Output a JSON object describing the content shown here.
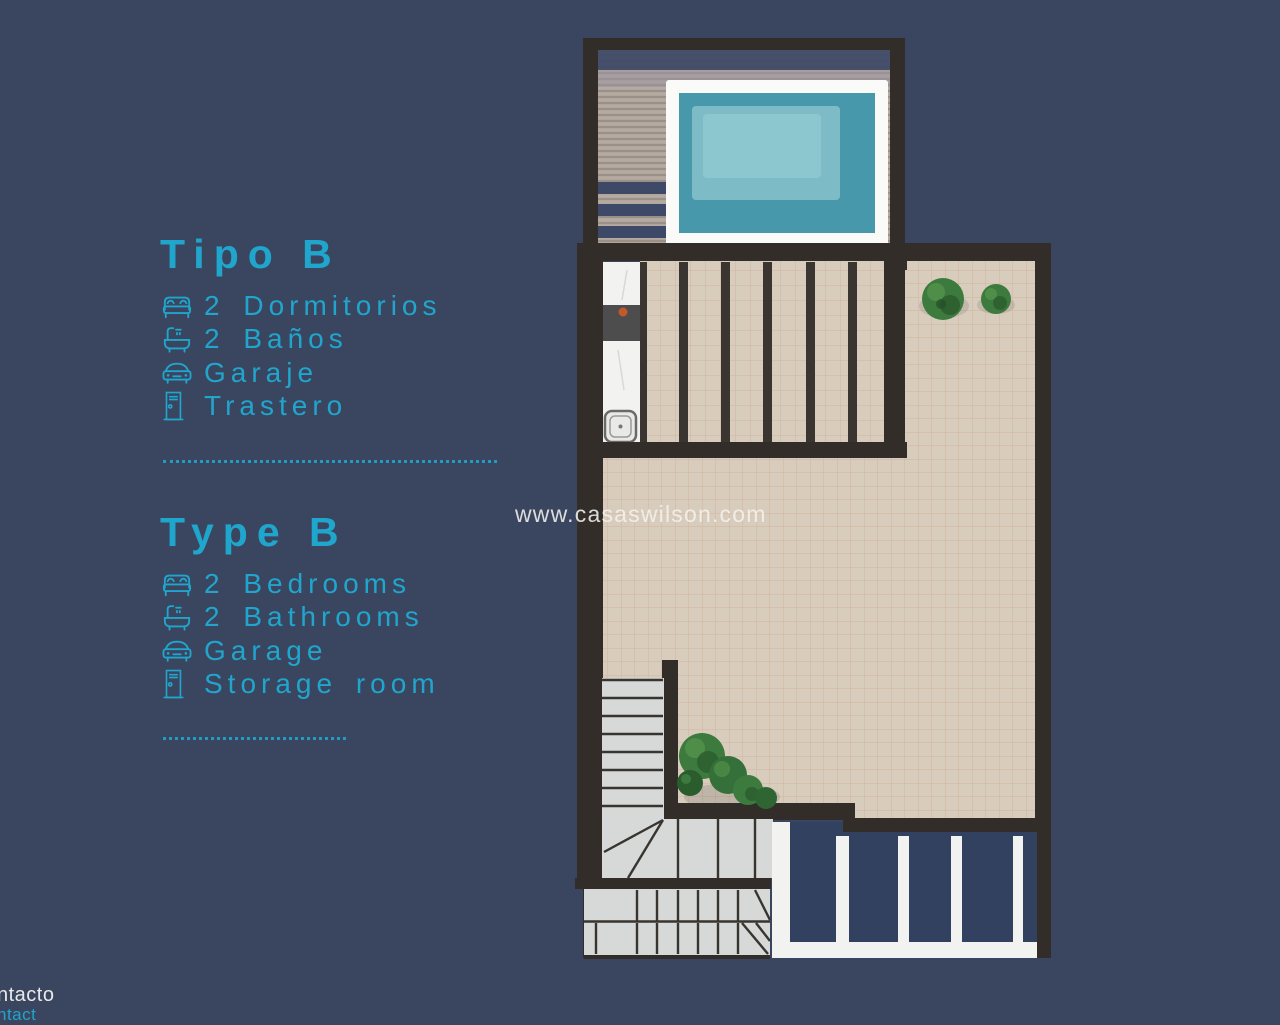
{
  "colors": {
    "background": "#3a455f",
    "accent_cyan": "#20a5cc",
    "wall": "#322d29",
    "tile": "#d8ccbd",
    "tile_line": "#c89a72",
    "deck": "#b1a69c",
    "deck_band": "#3d4966",
    "pool_deck": "#fafaf8",
    "pool_water": "#4898ab",
    "pool_water_light": "#8fc8cf",
    "stairs": "#d6d9d8",
    "stair_line": "#38342f",
    "railing_navy": "#32415f",
    "rail_white": "#f2f3f1",
    "kitchen_dark": "#4d4d4d",
    "burner_orange": "#c2592b",
    "bush_green": "#3f7d41",
    "watermark_white": "#f4f2ee",
    "corner_white": "#e9e9e9"
  },
  "legend_es": {
    "title": "Tipo B",
    "items": [
      {
        "icon": "bed-icon",
        "label": "2 Dormitorios"
      },
      {
        "icon": "bath-icon",
        "label": "2 Baños"
      },
      {
        "icon": "car-icon",
        "label": "Garaje"
      },
      {
        "icon": "door-icon",
        "label": "Trastero"
      }
    ]
  },
  "legend_en": {
    "title": "Type B",
    "items": [
      {
        "icon": "bed-icon",
        "label": "2 Bedrooms"
      },
      {
        "icon": "bath-icon",
        "label": "2 Bathrooms"
      },
      {
        "icon": "car-icon",
        "label": "Garage"
      },
      {
        "icon": "door-icon",
        "label": "Storage room"
      }
    ]
  },
  "watermark": {
    "text": "www.casaswilson.com"
  },
  "corner_links": {
    "line1": "ntacto",
    "line2": "ntact"
  }
}
